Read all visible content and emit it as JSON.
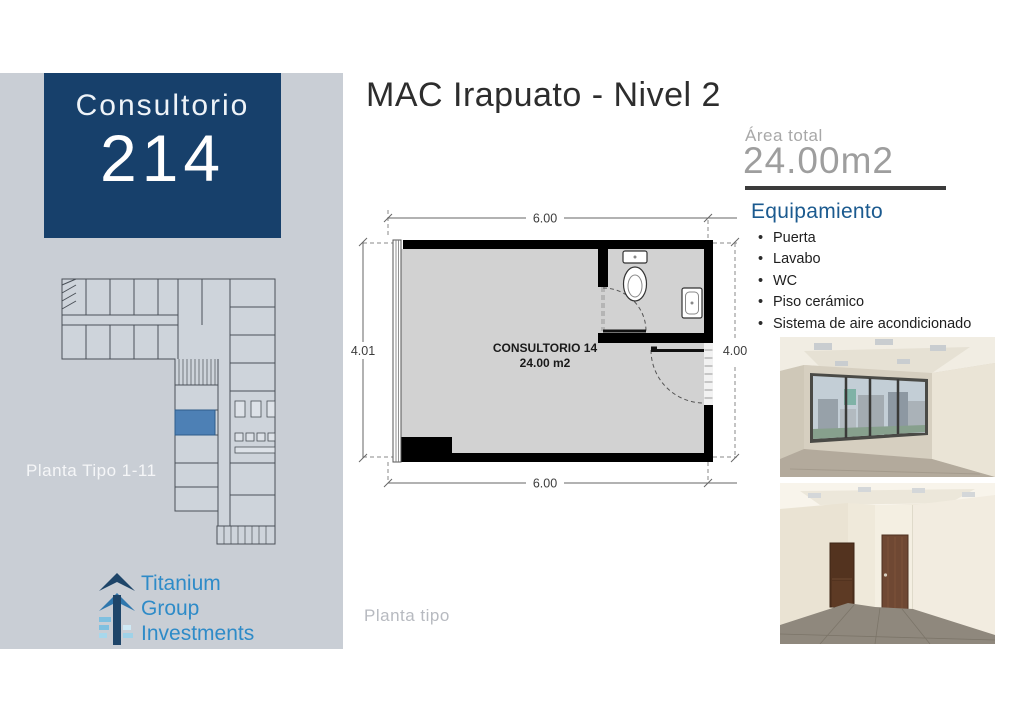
{
  "sidebar": {
    "badge": {
      "label": "Consultorio",
      "number": "214",
      "bg_color": "#17406b",
      "text_color": "#ffffff"
    },
    "keyplan_caption": "Planta Tipo 1-11",
    "keyplan": {
      "highlight_color": "#4d80b5"
    },
    "logo": {
      "lines": [
        "Titanium",
        "Group",
        "Investments"
      ],
      "text_color": "#2e8bc8"
    },
    "bg_color": "#c9ced5"
  },
  "header": {
    "title": "MAC Irapuato - Nivel 2"
  },
  "area": {
    "label": "Área total",
    "value": "24.00m2"
  },
  "equipment": {
    "heading": "Equipamiento",
    "heading_color": "#1b5a8f",
    "items": [
      "Puerta",
      "Lavabo",
      "WC",
      "Piso cerámico",
      "Sistema de aire acondicionado"
    ]
  },
  "floorplan": {
    "room_name": "CONSULTORIO 14",
    "room_area": "24.00 m2",
    "dim_top": "6.00",
    "dim_bottom": "6.00",
    "dim_left": "4.01",
    "dim_right": "4.00",
    "caption": "Planta tipo"
  },
  "photos": {
    "photo1_name": "office-interior-window-render",
    "photo2_name": "office-interior-doors-render"
  }
}
